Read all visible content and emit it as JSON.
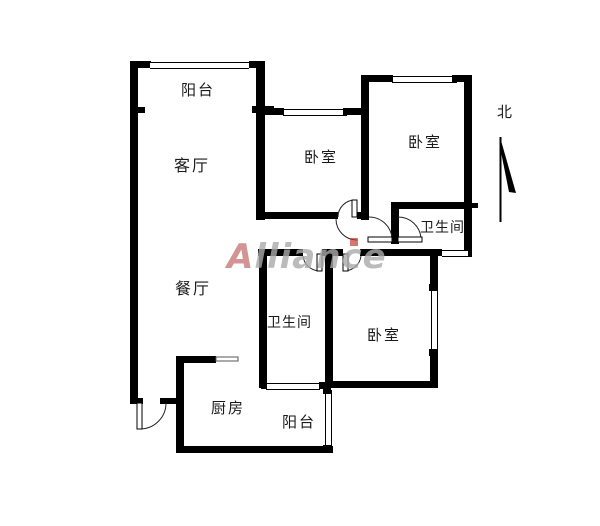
{
  "floorplan": {
    "rooms": {
      "balcony_top": "阳台",
      "living_room": "客厅",
      "bedroom_top_left": "卧室",
      "bedroom_top_right": "卧室",
      "bathroom_top": "卫生间",
      "dining_room": "餐厅",
      "bathroom_bottom": "卫生间",
      "bedroom_bottom_right": "卧室",
      "kitchen": "厨房",
      "balcony_bottom": "阳台"
    },
    "compass": {
      "north_label": "北"
    },
    "watermark": {
      "text": "Alliance"
    },
    "colors": {
      "wall": "#000000",
      "background": "#ffffff",
      "watermark_gray": "#ababab",
      "watermark_red": "#c0392b"
    }
  }
}
